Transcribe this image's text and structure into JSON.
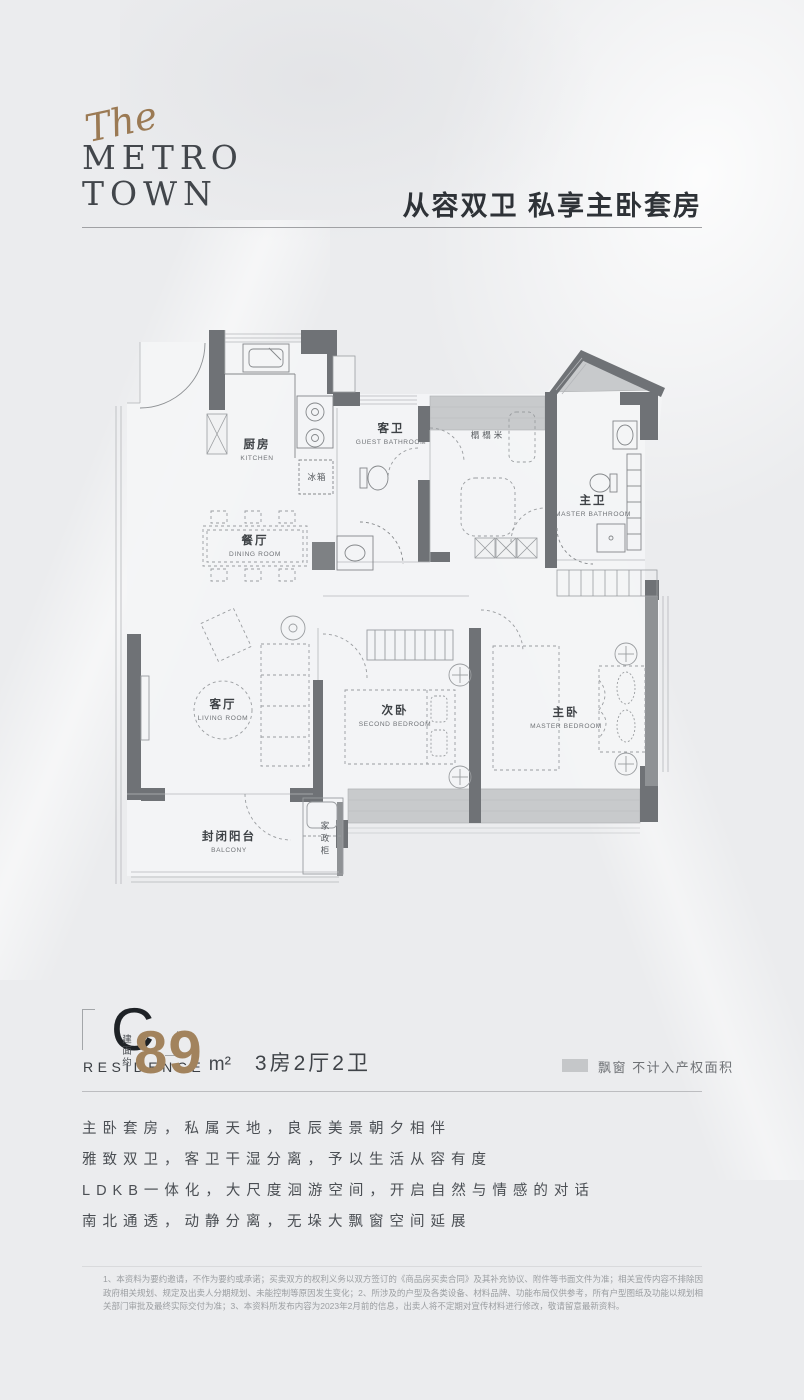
{
  "brand": {
    "script": "The",
    "line1": "METRO",
    "line2": "TOWN"
  },
  "headline": "从容双卫 私享主卧套房",
  "floorplan": {
    "rooms": {
      "kitchen": {
        "zh": "厨房",
        "en": "KITCHEN"
      },
      "guest_bath": {
        "zh": "客卫",
        "en": "GUEST BATHROOM"
      },
      "master_bath": {
        "zh": "主卫",
        "en": "MASTER BATHROOM"
      },
      "tatami": {
        "zh": "榻榻米"
      },
      "dining": {
        "zh": "餐厅",
        "en": "DINING ROOM"
      },
      "living": {
        "zh": "客厅",
        "en": "LIVING ROOM"
      },
      "second_bedroom": {
        "zh": "次卧",
        "en": "SECOND BEDROOM"
      },
      "master_bedroom": {
        "zh": "主卧",
        "en": "MASTER BEDROOM"
      },
      "balcony": {
        "zh": "封闭阳台",
        "en": "BALCONY"
      },
      "fridge": {
        "zh": "冰箱"
      },
      "utility_cabinet": {
        "zh": "家政柜"
      }
    }
  },
  "unit": {
    "type_letter": "C",
    "type_word": "RESIDENCE",
    "area_prefix": "建面约",
    "area_value": "89",
    "area_unit": "m²",
    "layout": "3房2厅2卫"
  },
  "legend": {
    "label": "飘窗 不计入产权面积"
  },
  "selling_points": [
    "主卧套房，私属天地，良辰美景朝夕相伴",
    "雅致双卫，客卫干湿分离，予以生活从容有度",
    "LDKB一体化，大尺度洄游空间，开启自然与情感的对话",
    "南北通透，动静分离，无垛大飘窗空间延展"
  ],
  "disclaimer": "1、本资料为要约邀请，不作为要约或承诺；买卖双方的权利义务以双方签订的《商品房买卖合同》及其补充协议、附件等书面文件为准；相关宣传内容不排除因政府相关规划、规定及出卖人分期规划、未能控制等原因发生变化；2、所涉及的户型及各类设备、材料品牌、功能布局仅供参考，所有户型图纸及功能以规划相关部门审批及最终实际交付为准；3、本资料所发布内容为2023年2月前的信息，出卖人将不定期对宣传材料进行修改，敬请留意最新资料。",
  "colors": {
    "accent_brown": "#a2835d",
    "wall": "#6f7276",
    "bay_window": "#c8cacc"
  }
}
